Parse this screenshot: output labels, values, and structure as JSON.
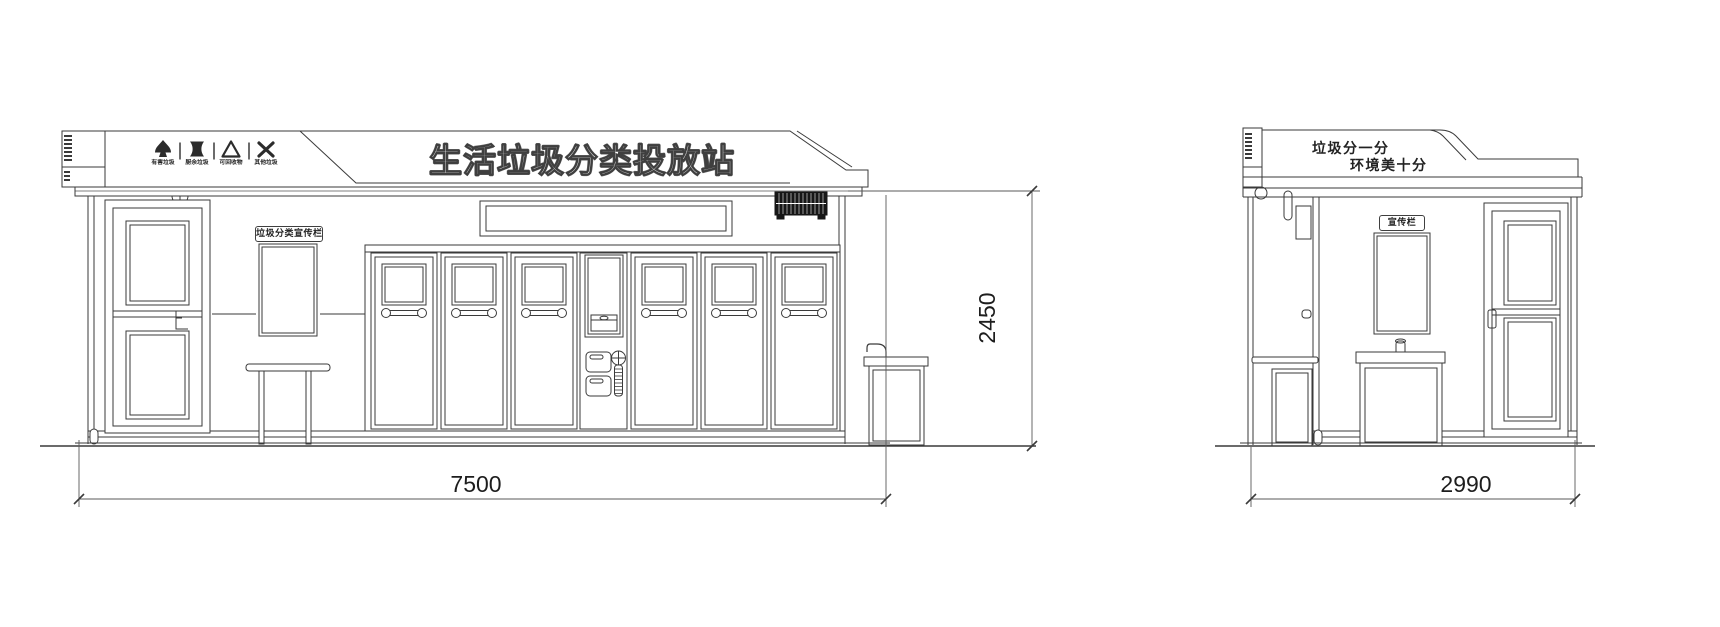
{
  "colors": {
    "line": "#3a3a3a",
    "vent_fill": "#161616",
    "background": "#ffffff"
  },
  "front": {
    "header": {
      "title": "生活垃圾分类投放站",
      "icons": [
        {
          "name": "hazardous-waste-icon",
          "label": "有害垃圾"
        },
        {
          "name": "food-waste-icon",
          "label": "厨余垃圾"
        },
        {
          "name": "recyclable-waste-icon",
          "label": "可回收物"
        },
        {
          "name": "other-waste-icon",
          "label": "其他垃圾"
        }
      ]
    },
    "publicity_board_label": "垃圾分类宣传栏",
    "dim_width": "7500",
    "dim_height": "2450"
  },
  "side": {
    "header": {
      "slogan_line1": "垃圾分一分",
      "slogan_line2": "环境美十分"
    },
    "publicity_board_label": "宣传栏",
    "dim_width": "2990"
  }
}
